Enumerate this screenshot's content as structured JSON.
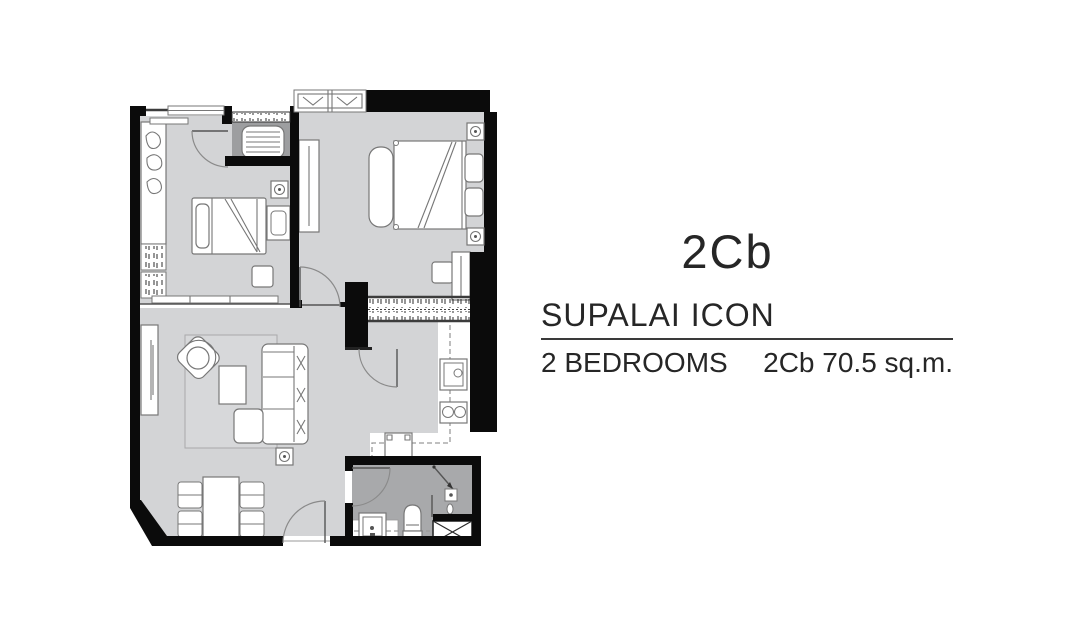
{
  "side_panel": {
    "unit_code": "2Cb",
    "project_name": "SUPALAI ICON",
    "bedrooms_label": "2 BEDROOMS",
    "area_label": "2Cb 70.5 sq.m."
  },
  "floor_plan_colors": {
    "wall": "#0b0b0b",
    "floor": "#d3d4d6",
    "wet_floor": "#a8a9ab",
    "alcove_floor": "#9d9ea0",
    "kitchen_floor": "#ffffff",
    "furniture_line": "#777777"
  }
}
